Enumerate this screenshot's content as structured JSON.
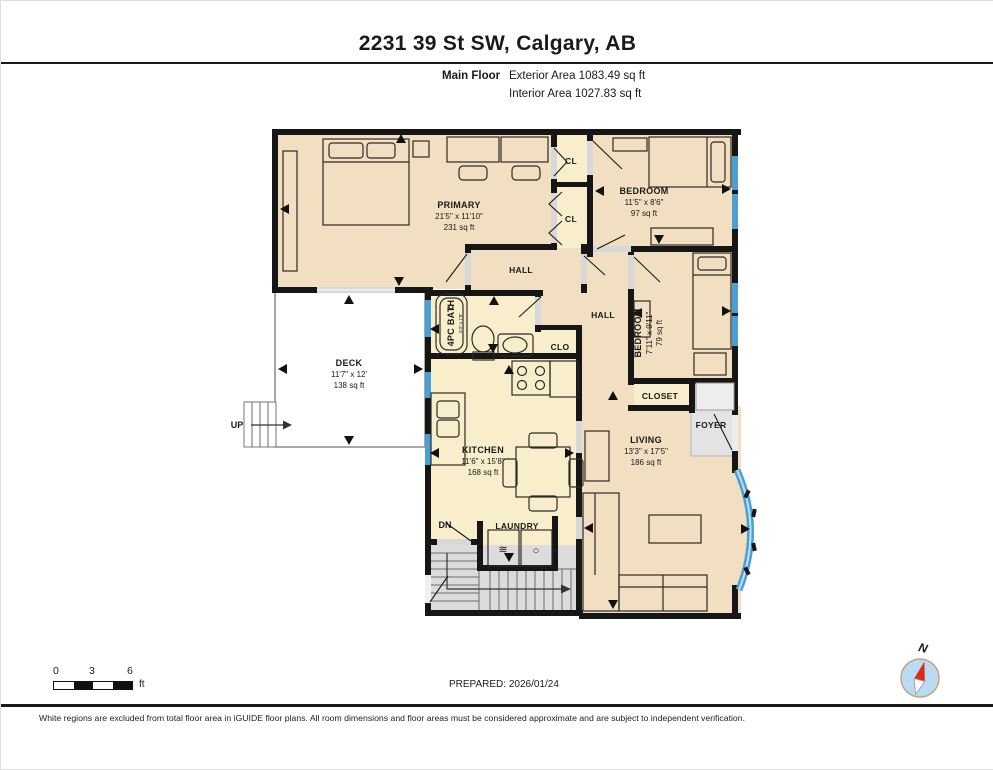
{
  "header": {
    "title": "2231 39 St SW, Calgary, AB",
    "floor_label": "Main Floor",
    "exterior_area": "Exterior Area 1083.49 sq ft",
    "interior_area": "Interior Area 1027.83 sq ft"
  },
  "rooms": {
    "primary": {
      "name": "PRIMARY",
      "dims": "21'5\" x 11'10\"",
      "area": "231 sq ft"
    },
    "bedroom2": {
      "name": "BEDROOM",
      "dims": "11'5\" x 8'6\"",
      "area": "97 sq ft"
    },
    "bedroom3": {
      "name": "BEDROOM",
      "dims": "7'11\" x 9'11\"",
      "area": "79 sq ft"
    },
    "deck": {
      "name": "DECK",
      "dims": "11'7\" x 12'",
      "area": "138 sq ft"
    },
    "kitchen": {
      "name": "KITCHEN",
      "dims": "11'6\" x 15'8\"",
      "area": "168 sq ft"
    },
    "living": {
      "name": "LIVING",
      "dims": "13'3\" x 17'5\"",
      "area": "186 sq ft"
    },
    "bath": {
      "name": "4PC BATH",
      "dims": "5'3\" x 7'8\""
    },
    "hall_upper": "HALL",
    "hall_main": "HALL",
    "closet1": "CL",
    "closet2": "CL",
    "clo": "CLO",
    "closet_living": "CLOSET",
    "foyer": "FOYER",
    "laundry": "LAUNDRY",
    "up_label": "UP",
    "dn_label": "DN"
  },
  "icons": {
    "washer_icon": "≋",
    "dryer_icon": "○"
  },
  "scale_bar": {
    "ticks": [
      "0",
      "3",
      "6"
    ],
    "unit": "ft"
  },
  "compass": {
    "label": "N"
  },
  "footer": {
    "prepared": "PREPARED: 2026/01/24",
    "disclaimer": "White regions are excluded from total floor area in iGUIDE floor plans. All room dimensions and floor areas must be considered approximate and are subject to independent verification."
  },
  "colors": {
    "room_tan": "#f2dfc2",
    "room_yellow": "#f9eecb",
    "excluded_gray": "#e3e3e3",
    "stairs_gray": "#dcdcdc",
    "wall_black": "#161616",
    "window_blue": "#4aa0d5",
    "compass_blue": "#badcf2",
    "needle_red": "#d92b1c"
  }
}
